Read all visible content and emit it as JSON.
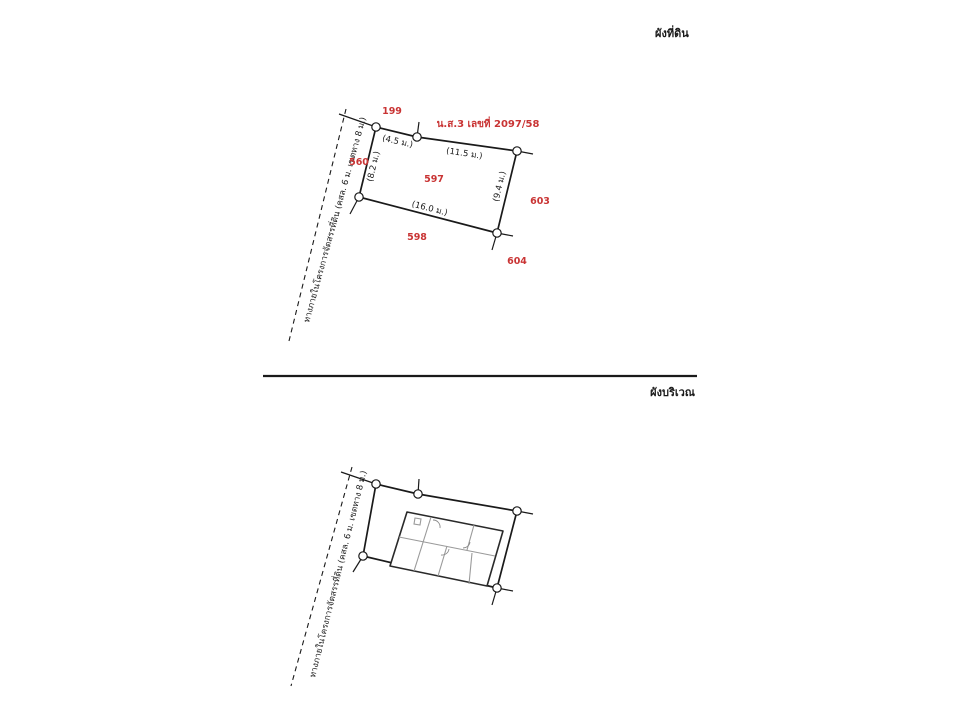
{
  "titles": {
    "land_plan": "ผังที่ดิน",
    "site_plan": "ผังบริเวณ"
  },
  "land_plan": {
    "deed_number": "น.ส.3 เลขที่ 2097/58",
    "parcels": {
      "north": "199",
      "west": "560",
      "center": "597",
      "south": "598",
      "east": "603",
      "southeast": "604"
    },
    "dimensions": {
      "top_left_segment": "(4.5 ม.)",
      "top_right_segment": "(11.5 ม.)",
      "left_side": "(8.2 ม.)",
      "bottom_side": "(16.0 ม.)",
      "right_side": "(9.4 ม.)"
    },
    "road_label": "ทางภายในโครงการจัดสรรที่ดิน (คสล. 6 ม. เขตทาง 8 ม.)"
  },
  "site_plan": {
    "road_label": "ทางภายในโครงการจัดสรรที่ดิน (คสล. 6 ม. เขตทาง 8 ม.)"
  },
  "colors": {
    "annotation_red": "#c93434",
    "line_black": "#1a1a1a",
    "building_gray": "#9a9a9a"
  }
}
